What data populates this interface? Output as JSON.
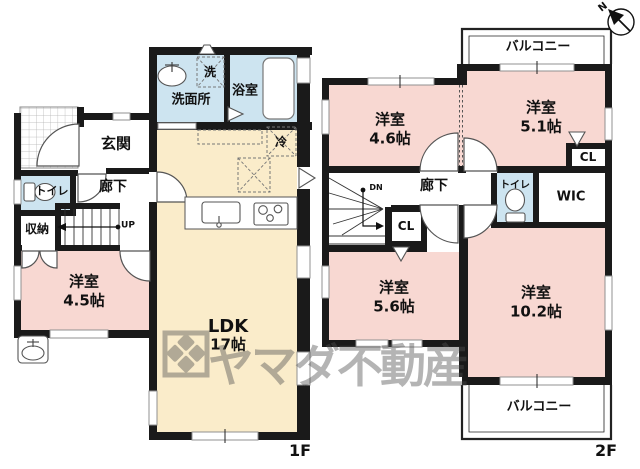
{
  "watermark": {
    "text": "ヤマダ不動産"
  },
  "compass": {
    "label": "N"
  },
  "colors": {
    "bedroom_pink": "#f8d8d2",
    "ldk_cream": "#faecca",
    "wet_blue": "#cde4f0",
    "wall_black": "#1a1a1a",
    "watermark_gray": "#4f4f4f"
  },
  "floor1": {
    "floor_label": "1F",
    "rooms": {
      "entrance": "玄関",
      "hallway": "廊下",
      "toilet": "トイレ",
      "storage": "収納",
      "washroom": "洗面所",
      "washer": "洗",
      "bathroom": "浴室",
      "fridge": "冷",
      "ldk_name": "LDK",
      "ldk_size": "17帖",
      "bedroom_name": "洋室",
      "bedroom_size": "4.5帖",
      "stairs_up": "UP"
    }
  },
  "floor2": {
    "floor_label": "2F",
    "rooms": {
      "balcony_top": "バルコニー",
      "balcony_bottom": "バルコニー",
      "bedroom1_name": "洋室",
      "bedroom1_size": "4.6帖",
      "bedroom2_name": "洋室",
      "bedroom2_size": "5.1帖",
      "bedroom3_name": "洋室",
      "bedroom3_size": "5.6帖",
      "bedroom4_name": "洋室",
      "bedroom4_size": "10.2帖",
      "hallway": "廊下",
      "toilet": "トイレ",
      "wic": "WIC",
      "closet_upper": "CL",
      "closet_lower": "CL",
      "stairs_down": "DN"
    }
  }
}
